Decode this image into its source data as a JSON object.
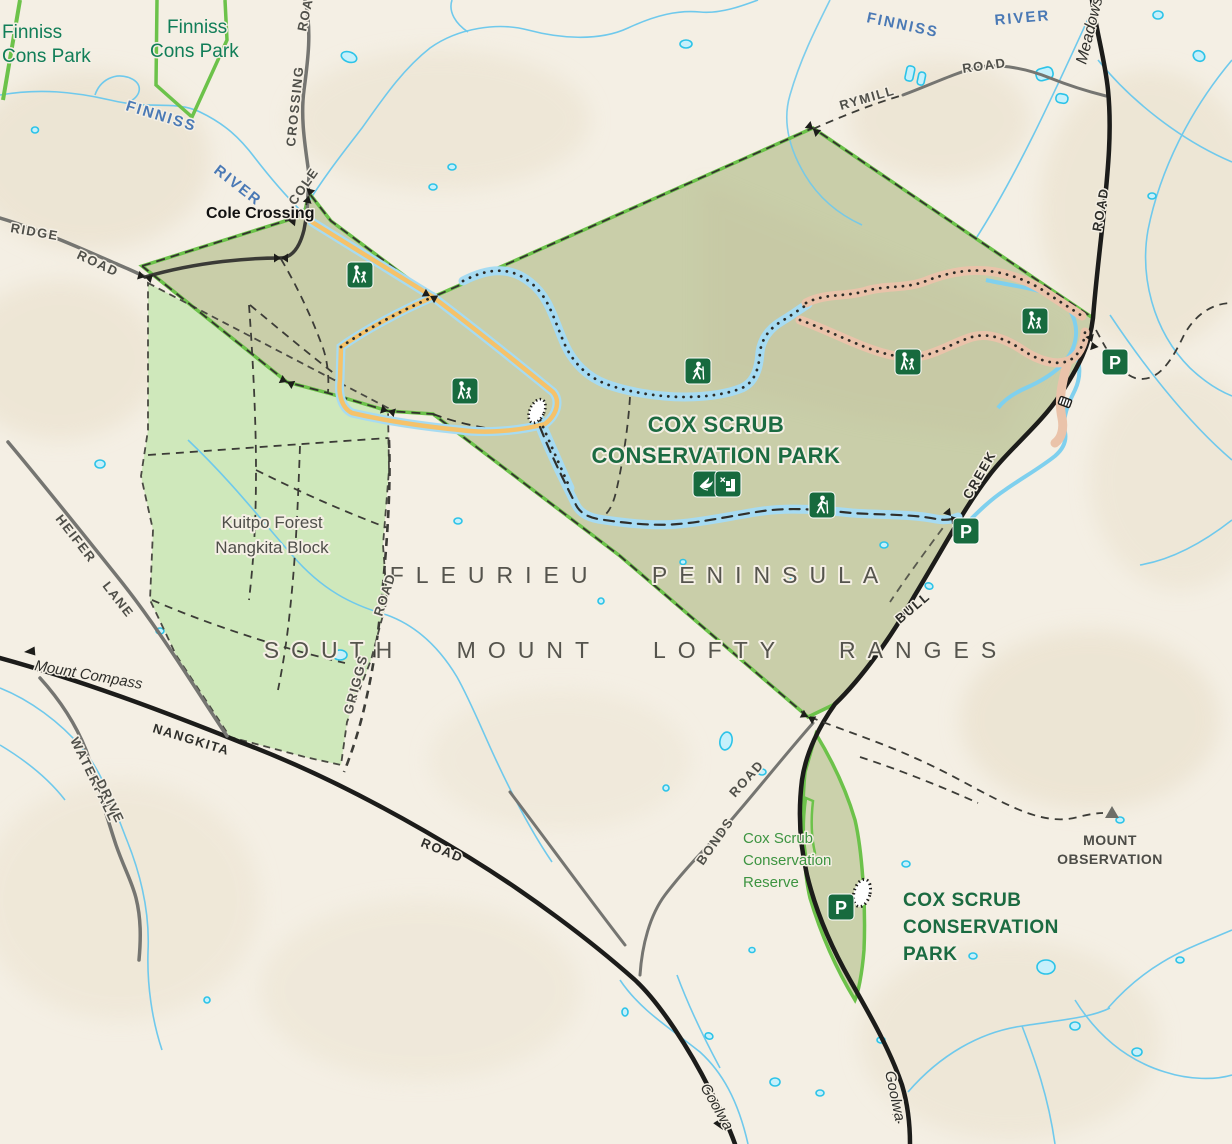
{
  "map": {
    "type": "park-visitor-map",
    "region_labels": {
      "region1": "FLEURIEU PENINSULA",
      "region2": "SOUTH MOUNT LOFTY RANGES"
    },
    "parks": {
      "main_title_line1": "COX SCRUB",
      "main_title_line2": "CONSERVATION PARK",
      "south_block_line1": "COX SCRUB",
      "south_block_line2": "CONSERVATION",
      "south_block_line3": "PARK",
      "reserve_line1": "Cox Scrub",
      "reserve_line2": "Conservation",
      "reserve_line3": "Reserve",
      "finniss_nw_line1": "Finniss",
      "finniss_nw_line2": "Cons Park",
      "finniss_n_line1": "Finniss",
      "finniss_n_line2": "Cons Park",
      "kuitpo_line1": "Kuitpo Forest",
      "kuitpo_line2": "Nangkita Block"
    },
    "water": {
      "river_w_word1": "FINNISS",
      "river_w_word2": "RIVER",
      "river_e_word1": "FINNISS",
      "river_e_word2": "RIVER"
    },
    "roads": {
      "cole_crossing_word1": "COLE",
      "cole_crossing_word2": "CROSSING",
      "cole_crossing_word3": "ROAD",
      "ridge_word1": "RIDGE",
      "ridge_word2": "ROAD",
      "rymill_word1": "RYMILL",
      "rymill_word2": "ROAD",
      "meadows_word1": "Meadows",
      "meadows_word2": "ROAD",
      "nangkita_word1": "NANGKITA",
      "nangkita_word2": "ROAD",
      "heifer_word1": "HEIFER",
      "heifer_word2": "LANE",
      "waterfall_word1": "WATERFALL",
      "waterfall_word2": "DRIVE",
      "griggs_word1": "GRIGGS",
      "griggs_word2": "ROAD",
      "bull_creek_word1": "BULL",
      "bull_creek_word2": "CREEK",
      "bonds_word1": "BONDS",
      "bonds_word2": "ROAD"
    },
    "places": {
      "cole_crossing": "Cole Crossing",
      "mount_observation_line1": "MOUNT",
      "mount_observation_line2": "OBSERVATION",
      "dest_mount_compass": "Mount Compass",
      "dest_goolwa_w": "Goolwa",
      "dest_goolwa_e": "Goolwa"
    },
    "icons": {
      "parking_letter": "P",
      "names": [
        "hiker-icon",
        "walk-with-child-icon",
        "parking-icon",
        "bird-watching-icon",
        "activity-icon",
        "gate-icon",
        "cattle-grid-icon",
        "sand-patch",
        "peak-triangle-icon",
        "road-arrow-icon"
      ]
    },
    "colors": {
      "background": "#f4efe4",
      "terrain_shade": "#e6dcc5",
      "park_fill": "#c9cea9",
      "forest_fill": "#cfe8bb",
      "park_border_green": "#6cc24a",
      "icon_green": "#176a3e",
      "road_gray": "#757571",
      "road_black": "#1c1c1a",
      "river_blue": "#6fc9ec",
      "pond_fill": "#c6f0fb",
      "pond_stroke": "#2cc3e8",
      "trail_casing_blue": "#a6dbf2",
      "trail_orange": "#f5c26a",
      "trail_casing_pink": "#eac3aa",
      "title_green": "#1b6b41",
      "label_gray": "#55544d"
    }
  }
}
